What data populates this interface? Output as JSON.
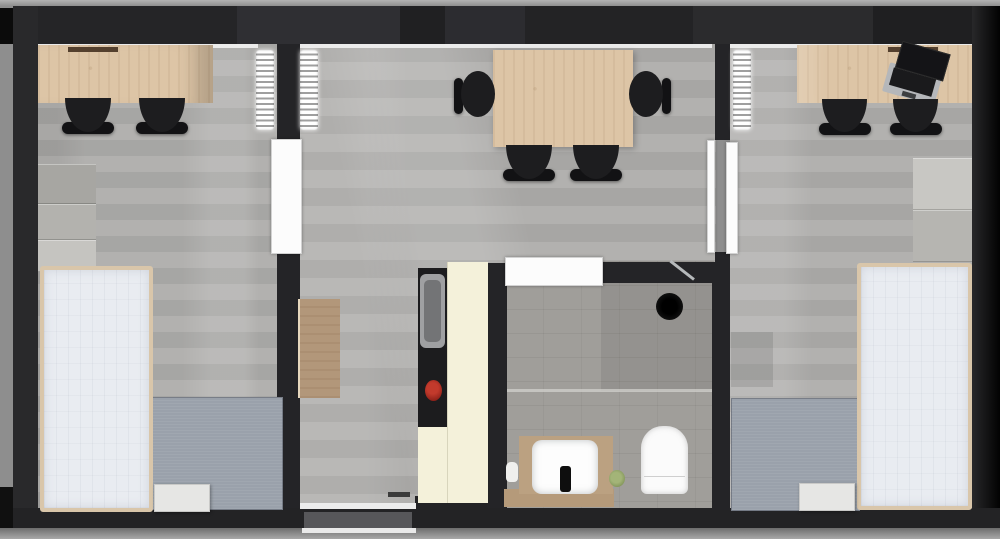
{
  "meta": {
    "title": "Apartment floor plan – rendered top-down view",
    "view": "top-down 3D render",
    "visible_text": "none"
  },
  "palette": {
    "margin": "#8e8e8e",
    "wall": "#29292b",
    "wall-dark": "#1f1f21",
    "floor": "#aeadab",
    "bath-floor": "#a09e9a",
    "wood": "#ddc5a6",
    "wood-dark": "#b2977a",
    "cream": "#f4f1da",
    "mattress": "#e9ecf1",
    "bed-frame": "#d9c6aa",
    "rug": "#9aa1ab",
    "chair": "#1d1d1f",
    "steel": "#b6b9bb",
    "red-pot": "#9c251c",
    "plant-green": "#8ea164",
    "door-white": "#fcfcfc"
  },
  "rooms": [
    {
      "id": "bedroom-left",
      "label": "left bedroom",
      "contents": [
        "wooden desk",
        "desk tray",
        "2 black chairs",
        "wall shelf unit (3 boxes)",
        "single bed",
        "gray rug",
        "white stool",
        "radiator",
        "white interior door"
      ]
    },
    {
      "id": "living-dining-middle",
      "label": "middle living / dining room",
      "contents": [
        "wooden dining table",
        "4 black chairs",
        "wooden sideboard",
        "kitchenette counter with steel sink and red pot on hob",
        "radiator",
        "floor window with white sills",
        "white interior doors"
      ]
    },
    {
      "id": "bathroom",
      "label": "bathroom",
      "contents": [
        "shower head",
        "glass partition",
        "wooden vanity",
        "white square basin with black faucet",
        "soap bottle",
        "green plant",
        "toilet",
        "white door"
      ]
    },
    {
      "id": "bedroom-right",
      "label": "right bedroom",
      "contents": [
        "wooden desk",
        "open laptop",
        "desk tray",
        "2 black chairs",
        "wall shelf unit (2 boxes)",
        "single bed",
        "gray rug",
        "white stool",
        "radiator",
        "white interior door"
      ]
    }
  ]
}
